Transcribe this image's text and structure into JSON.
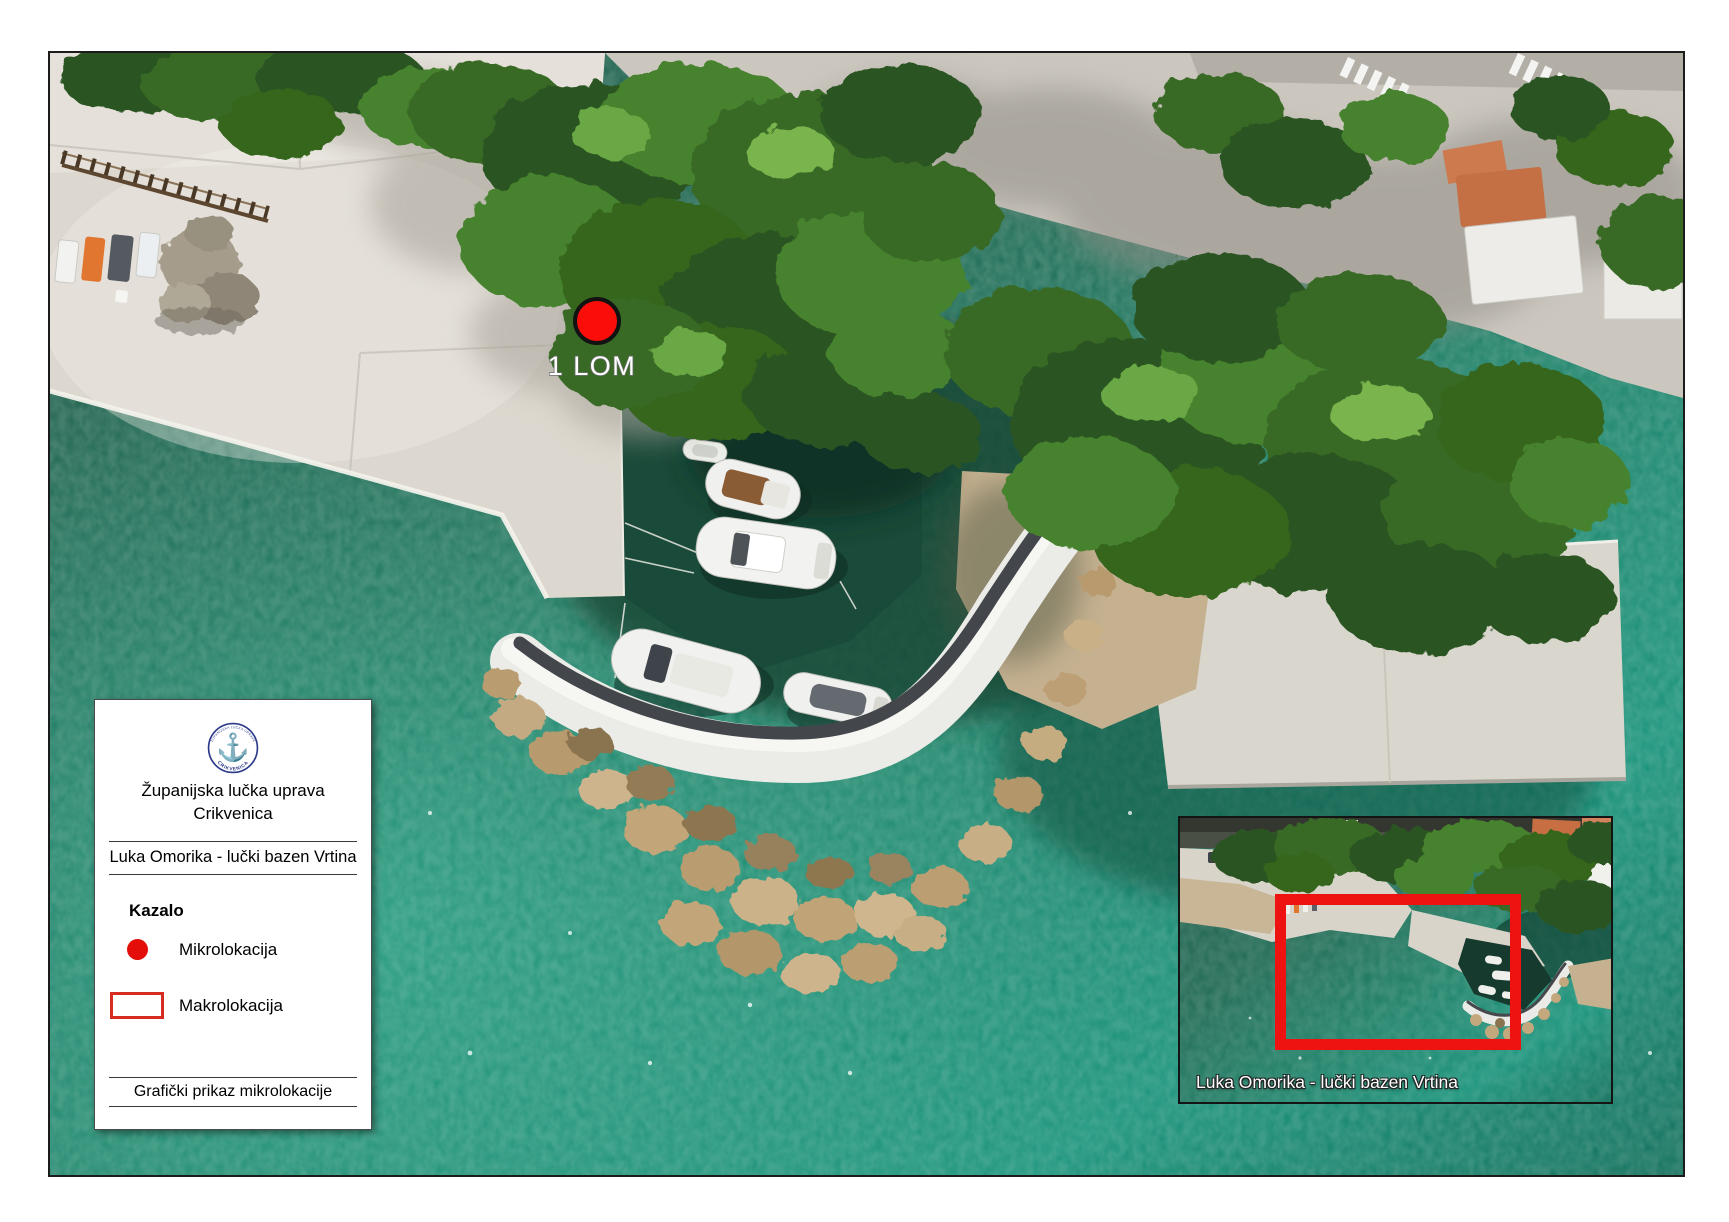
{
  "marker": {
    "label": "1 LOM",
    "color": "#fb0e0a"
  },
  "legend": {
    "logo": {
      "arc_text_top": "ŽUPANIJSKA LUČKA UPRAVA",
      "arc_text_bottom": "CRIKVENICA",
      "symbol": "anchor",
      "color": "#2c3a8a"
    },
    "organization_line1": "Županijska lučka uprava",
    "organization_line2": "Crikvenica",
    "project_title": "Luka Omorika - lučki bazen Vrtina",
    "index_heading": "Kazalo",
    "items": [
      {
        "symbol": "red-dot",
        "label": "Mikrolokacija"
      },
      {
        "symbol": "red-rectangle",
        "label": "Makrolokacija"
      }
    ],
    "footer": "Grafički prikaz mikrolokacije"
  },
  "inset": {
    "caption": "Luka Omorika - lučki bazen Vrtina"
  },
  "colors": {
    "accent_red": "#ee1310",
    "water_deep": "#1c5a47",
    "water_bright": "#1da089",
    "pavement": "#dcd8cf",
    "tree_dark": "#2c5520"
  }
}
